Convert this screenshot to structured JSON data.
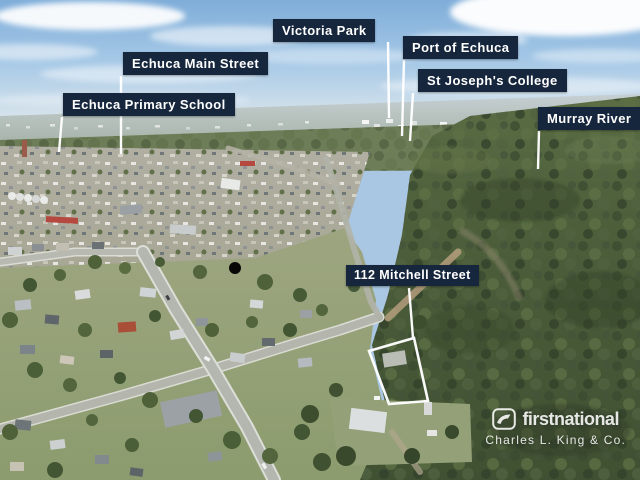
{
  "labels": {
    "victoria_park": "Victoria Park",
    "port_of_echuca": "Port of Echuca",
    "st_josephs_college": "St Joseph's College",
    "echuca_main_street": "Echuca Main Street",
    "echuca_primary_school": "Echuca Primary School",
    "murray_river": "Murray River",
    "property_address": "112 Mitchell Street"
  },
  "watermark": {
    "brand": "firstnational",
    "agency": "Charles L. King & Co."
  },
  "colors": {
    "label_bg": "#16263c",
    "label_text": "#ffffff",
    "annotation": "#ffffff"
  }
}
